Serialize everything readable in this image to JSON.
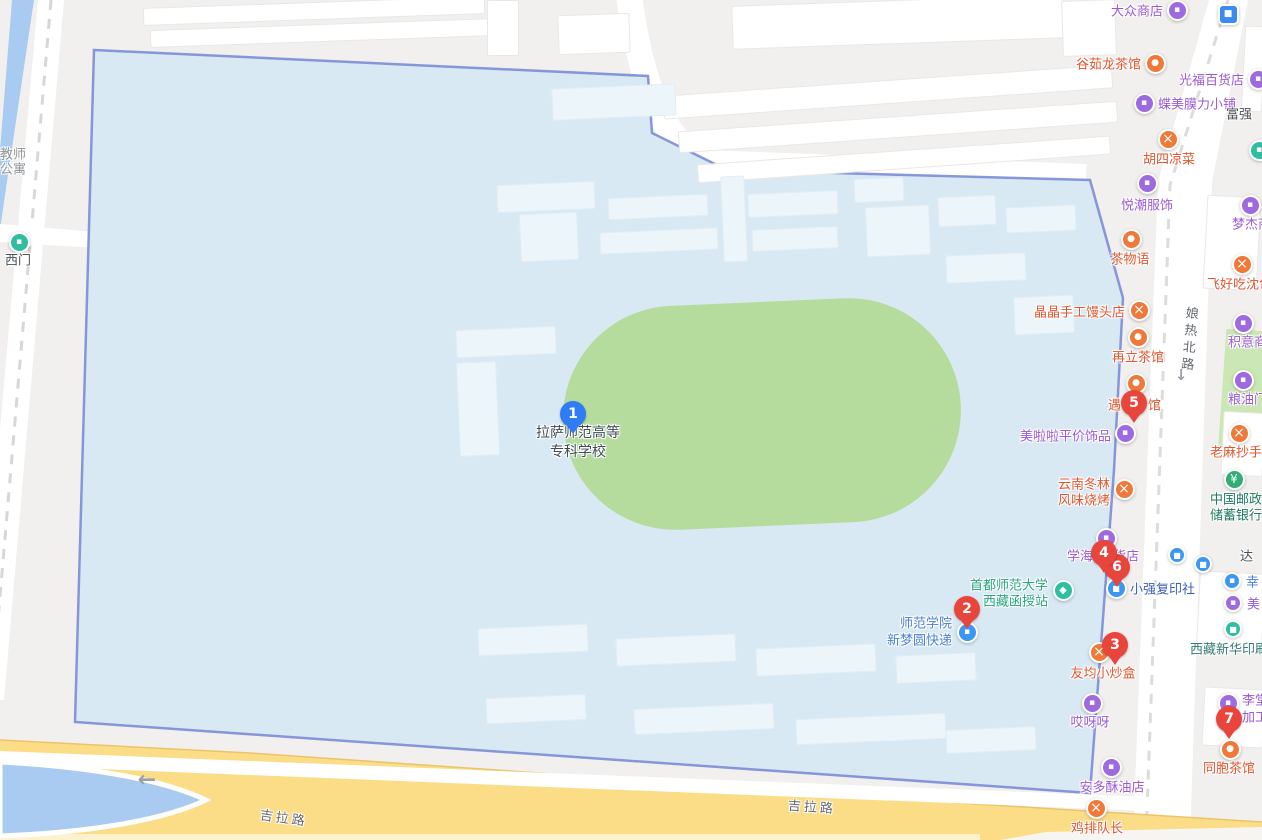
{
  "campus": {
    "line1": "拉萨师范高等",
    "line2": "专科学校"
  },
  "palette": {
    "campus_fill": "#d9e9f3",
    "campus_border": "#7b8cd6",
    "stadium": "#b5dc9d",
    "road_yellow": "#fbdd87",
    "water": "#a9cbf1",
    "poi_orange": "#f0793a",
    "poi_purple": "#9d6ae0",
    "poi_blue": "#3b97f2",
    "poi_teal": "#2fbfa0",
    "poi_green": "#2fae77",
    "pin_red": "#e8463d",
    "pin_blue": "#2e7cf6"
  },
  "glyphs": {
    "shop": "▪",
    "food": "×",
    "tea": "●",
    "bank": "¥",
    "edu": "◆",
    "bus": "■",
    "express": "▪",
    "print": "■",
    "gate": "▪",
    "transit": "■"
  },
  "markers": [
    {
      "n": "1",
      "color": "blue",
      "x": 573,
      "y": 414
    },
    {
      "n": "2",
      "color": "red",
      "x": 967,
      "y": 609
    },
    {
      "n": "3",
      "color": "red",
      "x": 1115,
      "y": 645
    },
    {
      "n": "6",
      "color": "red",
      "x": 1117,
      "y": 567
    },
    {
      "n": "4",
      "color": "red",
      "x": 1104,
      "y": 553
    },
    {
      "n": "5",
      "color": "red",
      "x": 1134,
      "y": 403
    },
    {
      "n": "7",
      "color": "red",
      "x": 1229,
      "y": 719
    }
  ],
  "road_labels": [
    {
      "t": "吉拉路",
      "x": 284,
      "y": 817,
      "rot": 8,
      "s": "road"
    },
    {
      "t": "吉拉路",
      "x": 812,
      "y": 806,
      "rot": 4,
      "s": "road"
    },
    {
      "t": "娘热北路",
      "x": 1188,
      "y": 340,
      "rot": 5,
      "s": "road",
      "vertical": true
    }
  ],
  "arrows": [
    {
      "t": "←",
      "x": 147,
      "y": 780,
      "size": 22
    },
    {
      "t": "↓",
      "x": 1181,
      "y": 375,
      "size": 15
    }
  ],
  "pois": [
    {
      "name": "dazhong-store",
      "cat": "shop",
      "icon": {
        "x": 1177,
        "y": 10
      },
      "labels": [
        {
          "t": "大众商店",
          "x": 1163,
          "y": 10,
          "a": "right",
          "s": "purple"
        }
      ]
    },
    {
      "name": "metro-station",
      "cat": "transit",
      "icon": {
        "x": 1228,
        "y": 14,
        "sq": true
      }
    },
    {
      "name": "gurulong-teahouse",
      "cat": "tea",
      "icon": {
        "x": 1155,
        "y": 63
      },
      "labels": [
        {
          "t": "谷茹龙茶馆",
          "x": 1141,
          "y": 63,
          "a": "right",
          "s": "orange"
        }
      ]
    },
    {
      "name": "guangfu-store",
      "cat": "shop",
      "icon": {
        "x": 1258,
        "y": 79
      },
      "labels": [
        {
          "t": "光福百货店",
          "x": 1244,
          "y": 79,
          "a": "right",
          "s": "purple"
        }
      ]
    },
    {
      "name": "diemei-shop",
      "cat": "shop",
      "icon": {
        "x": 1144,
        "y": 103
      },
      "labels": [
        {
          "t": "蝶美膜力小铺",
          "x": 1158,
          "y": 103,
          "a": "left",
          "s": "purple"
        }
      ]
    },
    {
      "name": "fuqiang-label",
      "labels": [
        {
          "t": "富强",
          "x": 1226,
          "y": 113,
          "a": "left",
          "s": "dark"
        }
      ]
    },
    {
      "name": "husi-cold-dishes",
      "cat": "food",
      "icon": {
        "x": 1168,
        "y": 139
      },
      "labels": [
        {
          "t": "胡四凉菜",
          "x": 1169,
          "y": 158,
          "a": "center",
          "s": "orange"
        }
      ]
    },
    {
      "name": "edge-poi",
      "cat": "gate",
      "icon": {
        "x": 1259,
        "y": 150
      }
    },
    {
      "name": "yuechao-clothing",
      "cat": "shop",
      "icon": {
        "x": 1147,
        "y": 183
      },
      "labels": [
        {
          "t": "悦潮服饰",
          "x": 1147,
          "y": 204,
          "a": "center",
          "s": "purple"
        }
      ]
    },
    {
      "name": "mengjie-store",
      "cat": "shop",
      "icon": {
        "x": 1250,
        "y": 205
      },
      "labels": [
        {
          "t": "梦杰商",
          "x": 1232,
          "y": 223,
          "a": "left",
          "s": "purple"
        }
      ]
    },
    {
      "name": "chawuyu-tea",
      "cat": "tea",
      "icon": {
        "x": 1131,
        "y": 239
      },
      "labels": [
        {
          "t": "茶物语",
          "x": 1130,
          "y": 258,
          "a": "center",
          "s": "orange"
        }
      ]
    },
    {
      "name": "feihaochi-baozi",
      "cat": "food",
      "icon": {
        "x": 1242,
        "y": 264
      },
      "labels": [
        {
          "t": "飞好吃沈包",
          "x": 1207,
          "y": 283,
          "a": "left",
          "s": "orange"
        }
      ]
    },
    {
      "name": "jingjing-mantou",
      "cat": "food",
      "icon": {
        "x": 1139,
        "y": 310
      },
      "labels": [
        {
          "t": "晶晶手工馒头店",
          "x": 1125,
          "y": 311,
          "a": "right",
          "s": "orange"
        }
      ]
    },
    {
      "name": "jiyi-store",
      "cat": "shop",
      "icon": {
        "x": 1243,
        "y": 323
      },
      "labels": [
        {
          "t": "积意商",
          "x": 1228,
          "y": 341,
          "a": "left",
          "s": "purple"
        }
      ]
    },
    {
      "name": "zaili-teahouse",
      "cat": "tea",
      "icon": {
        "x": 1138,
        "y": 337
      },
      "labels": [
        {
          "t": "再立茶馆",
          "x": 1138,
          "y": 356,
          "a": "center",
          "s": "orange"
        }
      ]
    },
    {
      "name": "liangyou-store",
      "cat": "shop",
      "icon": {
        "x": 1243,
        "y": 380
      },
      "labels": [
        {
          "t": "粮油门市",
          "x": 1228,
          "y": 398,
          "a": "left",
          "s": "purple"
        }
      ]
    },
    {
      "name": "yu-teahouse",
      "cat": "tea",
      "icon": {
        "x": 1136,
        "y": 383
      },
      "labels": [
        {
          "t": "遇",
          "x": 1121,
          "y": 404,
          "a": "right",
          "s": "orange"
        },
        {
          "t": "馆",
          "x": 1148,
          "y": 404,
          "a": "left",
          "s": "orange"
        }
      ]
    },
    {
      "name": "meilala-accessories",
      "cat": "shop",
      "icon": {
        "x": 1125,
        "y": 433
      },
      "labels": [
        {
          "t": "美啦啦平价饰品",
          "x": 1111,
          "y": 435,
          "a": "right",
          "s": "purple"
        }
      ]
    },
    {
      "name": "laoma-chaoshou",
      "cat": "food",
      "icon": {
        "x": 1239,
        "y": 433
      },
      "labels": [
        {
          "t": "老麻抄手",
          "x": 1210,
          "y": 451,
          "a": "left",
          "s": "orange"
        }
      ]
    },
    {
      "name": "yunnan-donglin-bbq",
      "cat": "food",
      "icon": {
        "x": 1124,
        "y": 489
      },
      "labels": [
        {
          "t": "云南冬林",
          "x": 1110,
          "y": 483,
          "a": "right",
          "s": "orange"
        },
        {
          "t": "风味烧烤",
          "x": 1110,
          "y": 499,
          "a": "right",
          "s": "orange"
        }
      ]
    },
    {
      "name": "china-post-savings-bank",
      "cat": "bank",
      "icon": {
        "x": 1234,
        "y": 479
      },
      "labels": [
        {
          "t": "中国邮政",
          "x": 1236,
          "y": 498,
          "a": "center",
          "s": "green"
        },
        {
          "t": "储蓄银行",
          "x": 1236,
          "y": 514,
          "a": "center",
          "s": "green"
        }
      ]
    },
    {
      "name": "xuehai-store",
      "cat": "shop",
      "icon": {
        "x": 1106,
        "y": 538
      },
      "labels": [
        {
          "t": "学海",
          "x": 1093,
          "y": 555,
          "a": "right",
          "s": "purple"
        },
        {
          "t": "货店",
          "x": 1113,
          "y": 555,
          "a": "left",
          "s": "purple"
        }
      ]
    },
    {
      "name": "bus-stop-1",
      "cat": "bus",
      "icon": {
        "x": 1177,
        "y": 555,
        "small": true
      }
    },
    {
      "name": "bus-stop-2",
      "cat": "bus",
      "icon": {
        "x": 1203,
        "y": 564,
        "small": true
      }
    },
    {
      "name": "da-label",
      "labels": [
        {
          "t": "达",
          "x": 1240,
          "y": 555,
          "a": "left",
          "s": "dark"
        }
      ]
    },
    {
      "name": "xing-poi",
      "cat": "express",
      "icon": {
        "x": 1232,
        "y": 581,
        "small": true
      },
      "labels": [
        {
          "t": "幸",
          "x": 1246,
          "y": 581,
          "a": "left",
          "s": "blue"
        }
      ]
    },
    {
      "name": "mei-poi",
      "cat": "shop",
      "icon": {
        "x": 1233,
        "y": 603,
        "small": true
      },
      "labels": [
        {
          "t": "美",
          "x": 1247,
          "y": 603,
          "a": "left",
          "s": "purple"
        }
      ]
    },
    {
      "name": "xiaoqiang-copy-shop",
      "cat": "print",
      "icon": {
        "x": 1116,
        "y": 588
      },
      "labels": [
        {
          "t": "小强复印社",
          "x": 1130,
          "y": 588,
          "a": "left",
          "s": "darkblue"
        }
      ]
    },
    {
      "name": "capital-normal-univ-tibet-station",
      "cat": "edu",
      "icon": {
        "x": 1063,
        "y": 590
      },
      "labels": [
        {
          "t": "首都师范大学",
          "x": 1048,
          "y": 584,
          "a": "right",
          "s": "teal"
        },
        {
          "t": "西藏函授站",
          "x": 1048,
          "y": 600,
          "a": "right",
          "s": "teal"
        }
      ]
    },
    {
      "name": "xinmengyuan-express",
      "cat": "express",
      "icon": {
        "x": 967,
        "y": 632
      },
      "labels": [
        {
          "t": "师范学院",
          "x": 952,
          "y": 622,
          "a": "right",
          "s": "blue"
        },
        {
          "t": "新梦圆快递",
          "x": 952,
          "y": 639,
          "a": "right",
          "s": "blue"
        }
      ]
    },
    {
      "name": "xinhua-printing",
      "cat": "print",
      "color": "edu",
      "icon": {
        "x": 1233,
        "y": 629,
        "small": true
      },
      "labels": [
        {
          "t": "西藏新华印刷",
          "x": 1190,
          "y": 648,
          "a": "left",
          "s": "tealdark"
        }
      ]
    },
    {
      "name": "youjun-restaurant",
      "cat": "food",
      "icon": {
        "x": 1099,
        "y": 652
      },
      "labels": [
        {
          "t": "友均小炒盒",
          "x": 1103,
          "y": 672,
          "a": "center",
          "s": "orange"
        }
      ]
    },
    {
      "name": "litang-processing",
      "cat": "shop",
      "icon": {
        "x": 1228,
        "y": 703
      },
      "labels": [
        {
          "t": "李堂",
          "x": 1242,
          "y": 699,
          "a": "left",
          "s": "purple"
        },
        {
          "t": "加工",
          "x": 1242,
          "y": 716,
          "a": "left",
          "s": "purple"
        }
      ]
    },
    {
      "name": "aiyaya-shop",
      "cat": "shop",
      "icon": {
        "x": 1092,
        "y": 703
      },
      "labels": [
        {
          "t": "哎呀呀",
          "x": 1090,
          "y": 721,
          "a": "center",
          "s": "purple"
        }
      ]
    },
    {
      "name": "tongbao-teahouse",
      "cat": "tea",
      "icon": {
        "x": 1230,
        "y": 749
      },
      "labels": [
        {
          "t": "同胞茶馆",
          "x": 1229,
          "y": 767,
          "a": "center",
          "s": "orange"
        }
      ]
    },
    {
      "name": "anduo-butter-shop",
      "cat": "shop",
      "icon": {
        "x": 1111,
        "y": 767
      },
      "labels": [
        {
          "t": "安多酥油店",
          "x": 1112,
          "y": 786,
          "a": "center",
          "s": "purple"
        }
      ]
    },
    {
      "name": "jipai-captain",
      "cat": "food",
      "icon": {
        "x": 1096,
        "y": 808
      },
      "labels": [
        {
          "t": "鸡排队长",
          "x": 1097,
          "y": 827,
          "a": "center",
          "s": "orange"
        }
      ]
    },
    {
      "name": "west-gate",
      "cat": "gate",
      "icon": {
        "x": 19,
        "y": 242
      },
      "labels": [
        {
          "t": "西门",
          "x": 18,
          "y": 259,
          "a": "center",
          "s": "dark"
        }
      ]
    },
    {
      "name": "teacher-apartment",
      "labels": [
        {
          "t": "教师",
          "x": 0,
          "y": 153,
          "a": "left",
          "s": "gray"
        },
        {
          "t": "公寓",
          "x": 0,
          "y": 168,
          "a": "left",
          "s": "gray"
        }
      ]
    }
  ]
}
